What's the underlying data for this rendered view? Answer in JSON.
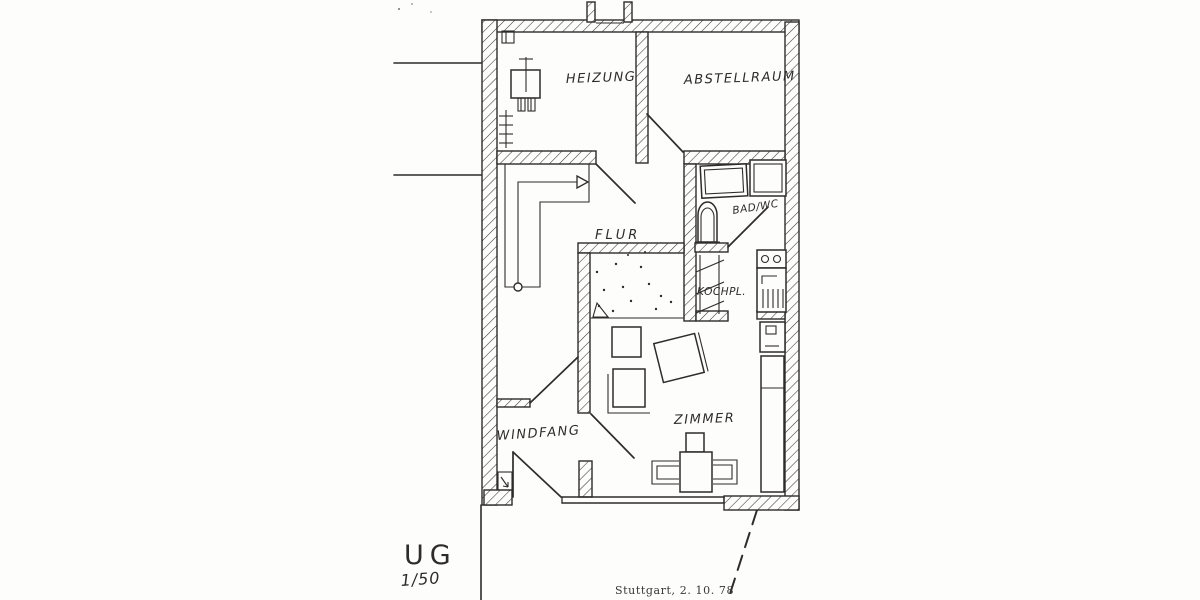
{
  "document": {
    "kind": "architectural-floor-plan-scan",
    "floor_label": "UG",
    "scale_label": "1/50",
    "annotation": "Stuttgart, 2. 10. 78"
  },
  "rooms": {
    "heizung": "HEIZUNG",
    "abstellraum": "ABSTELLRAUM",
    "flur": "FLUR",
    "bad_wc": "BAD/WC",
    "kochnische": "KOCHPL.",
    "zimmer": "ZIMMER",
    "windfang": "WINDFANG"
  },
  "colors": {
    "ink": "#2e2c29",
    "paper": "#fdfdfc"
  }
}
